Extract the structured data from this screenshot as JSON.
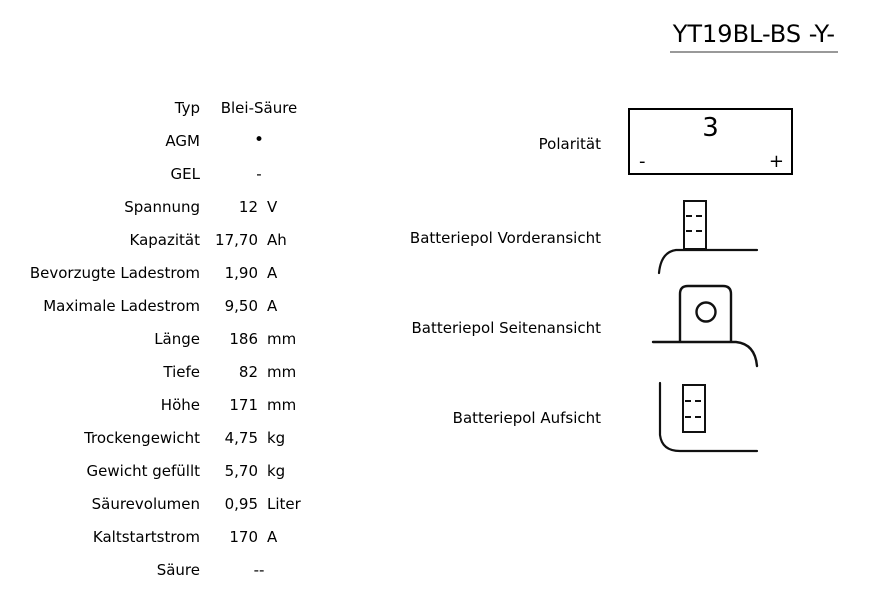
{
  "title": "YT19BL-BS -Y-",
  "specs": {
    "rows": [
      {
        "label": "Typ",
        "value": "Blei-Säure",
        "unit": ""
      },
      {
        "label": "AGM",
        "value": "•",
        "unit": ""
      },
      {
        "label": "GEL",
        "value": "-",
        "unit": ""
      },
      {
        "label": "Spannung",
        "value": "12",
        "unit": "V"
      },
      {
        "label": "Kapazität",
        "value": "17,70",
        "unit": "Ah"
      },
      {
        "label": "Bevorzugte Ladestrom",
        "value": "1,90",
        "unit": "A"
      },
      {
        "label": "Maximale Ladestrom",
        "value": "9,50",
        "unit": "A"
      },
      {
        "label": "Länge",
        "value": "186",
        "unit": "mm"
      },
      {
        "label": "Tiefe",
        "value": "82",
        "unit": "mm"
      },
      {
        "label": "Höhe",
        "value": "171",
        "unit": "mm"
      },
      {
        "label": "Trockengewicht",
        "value": "4,75",
        "unit": "kg"
      },
      {
        "label": "Gewicht gefüllt",
        "value": "5,70",
        "unit": "kg"
      },
      {
        "label": "Säurevolumen",
        "value": "0,95",
        "unit": "Liter"
      },
      {
        "label": "Kaltstartstrom",
        "value": "170",
        "unit": "A"
      },
      {
        "label": "Säure",
        "value": "--",
        "unit": ""
      }
    ]
  },
  "polarity": {
    "label": "Polarität",
    "value": "3",
    "minus": "-",
    "plus": "+"
  },
  "diagrams": {
    "front_label": "Batteriepol Vorderansicht",
    "side_label": "Batteriepol Seitenansicht",
    "top_label": "Batteriepol Aufsicht"
  },
  "colors": {
    "text": "#000000",
    "line": "#111111",
    "title_underline": "#999999",
    "background": "#ffffff"
  }
}
